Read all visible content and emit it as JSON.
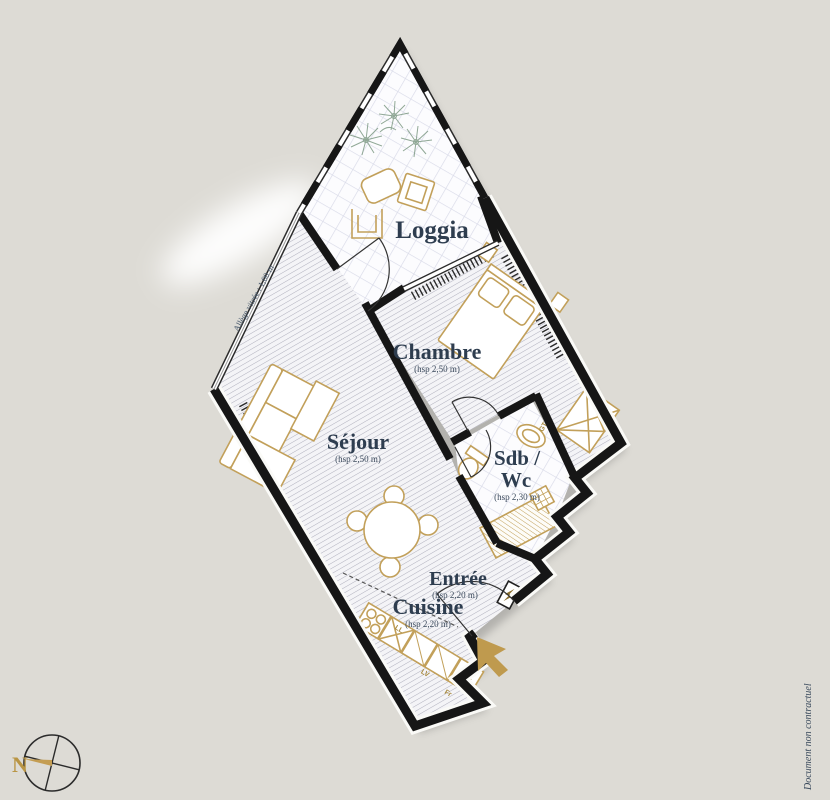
{
  "rooms": {
    "loggia": {
      "label": "Loggia"
    },
    "chambre": {
      "label": "Chambre",
      "hsp": "(hsp 2,50 m)"
    },
    "sejour": {
      "label": "Séjour",
      "hsp": "(hsp 2,50 m)"
    },
    "sdb": {
      "label_line1": "Sdb /",
      "label_line2": "Wc",
      "hsp": "(hsp 2,30 m)"
    },
    "entree": {
      "label": "Entrée",
      "hsp": "(hsp 2,20 m)"
    },
    "cuisine": {
      "label": "Cuisine",
      "hsp": "(hsp 2,20 m)"
    }
  },
  "annotations": {
    "window_sill": "Allège vitrée : 1,00 m",
    "disclaimer": "Document non contractuel",
    "north": "N"
  },
  "appliances": {
    "washer": "LL",
    "dishwasher": "LV",
    "fridge": "Fr",
    "duct": "GT"
  },
  "colors": {
    "paper": "#e9e7e1",
    "wall": "#161616",
    "gold": "#c2a05a",
    "label": "#2e3d4f",
    "tile_line": "#d8dae8",
    "hatch_line": "#aeaebc",
    "plant": "#7e9a84"
  }
}
